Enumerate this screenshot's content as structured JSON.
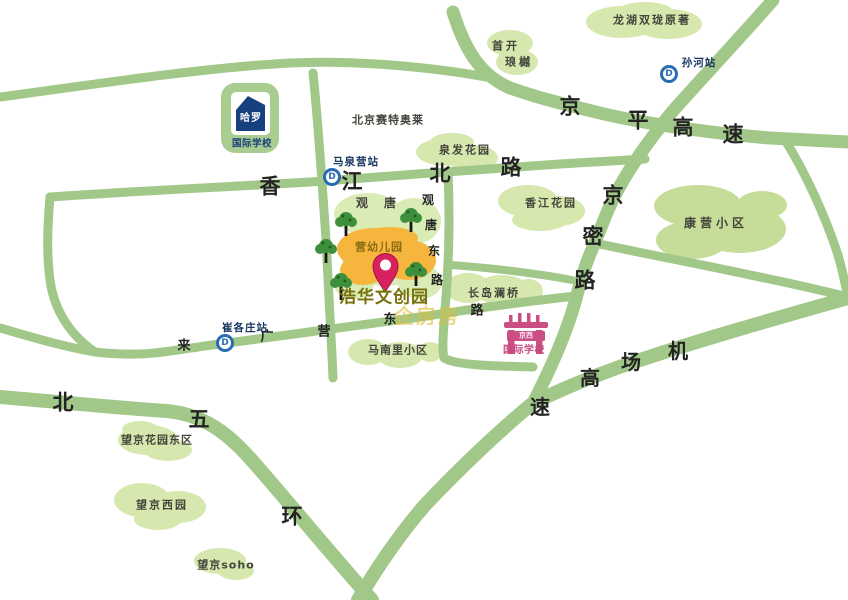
{
  "map": {
    "colors": {
      "road": "#a2c889",
      "area": "#d6e8ae",
      "area_dark": "#c6dd99",
      "area_light": "#d9ecb6",
      "orange": "#f6b63e",
      "tree": "#3e8f3b",
      "pin": "#d8215f",
      "station_blue": "#2a6cb2",
      "station_text": "#16365f",
      "harrow_blue": "#17407e",
      "pink": "#cb4f84",
      "road_text": "#232323",
      "area_text": "#44443c",
      "destination_text": "#77710a",
      "watermark": "#e2bd3a"
    },
    "station_icon_letter": "D",
    "road_label_groups": [
      {
        "id": "xiangjiang-north-road",
        "road": "香江北路",
        "size": 21,
        "chars": [
          {
            "t": "香",
            "x": 270,
            "y": 187
          },
          {
            "t": "江",
            "x": 352,
            "y": 182
          },
          {
            "t": "北",
            "x": 440,
            "y": 174
          },
          {
            "t": "路",
            "x": 511,
            "y": 168
          }
        ]
      },
      {
        "id": "jingping-expressway",
        "road": "京平高速",
        "size": 21,
        "chars": [
          {
            "t": "京",
            "x": 570,
            "y": 107
          },
          {
            "t": "平",
            "x": 638,
            "y": 121
          },
          {
            "t": "高",
            "x": 683,
            "y": 128
          },
          {
            "t": "速",
            "x": 733,
            "y": 135
          }
        ]
      },
      {
        "id": "jingmi-road",
        "road": "京密路",
        "size": 21,
        "chars": [
          {
            "t": "京",
            "x": 613,
            "y": 196
          },
          {
            "t": "密",
            "x": 593,
            "y": 237
          },
          {
            "t": "路",
            "x": 585,
            "y": 281
          }
        ]
      },
      {
        "id": "airport-expressway",
        "road": "机场高速",
        "size": 20,
        "chars": [
          {
            "t": "机",
            "x": 678,
            "y": 351
          },
          {
            "t": "场",
            "x": 631,
            "y": 362
          },
          {
            "t": "高",
            "x": 590,
            "y": 378
          },
          {
            "t": "速",
            "x": 540,
            "y": 407
          }
        ]
      },
      {
        "id": "north-fifth-ring",
        "road": "北五环",
        "size": 21,
        "chars": [
          {
            "t": "北",
            "x": 63,
            "y": 403
          },
          {
            "t": "五",
            "x": 199,
            "y": 420
          },
          {
            "t": "环",
            "x": 292,
            "y": 517
          }
        ]
      },
      {
        "id": "laiguangying-east-road",
        "road": "来广营东路",
        "size": 13,
        "chars": [
          {
            "t": "来",
            "x": 184,
            "y": 346
          },
          {
            "t": "广",
            "x": 267,
            "y": 337
          },
          {
            "t": "营",
            "x": 324,
            "y": 332
          },
          {
            "t": "东",
            "x": 390,
            "y": 320
          },
          {
            "t": "路",
            "x": 477,
            "y": 311
          }
        ]
      },
      {
        "id": "guantang-east-road",
        "road": "观唐东路",
        "size": 12,
        "chars": [
          {
            "t": "观",
            "x": 428,
            "y": 200
          },
          {
            "t": "唐",
            "x": 431,
            "y": 225
          },
          {
            "t": "东",
            "x": 434,
            "y": 251
          },
          {
            "t": "路",
            "x": 437,
            "y": 280
          }
        ]
      }
    ],
    "area_labels": [
      {
        "id": "beijing-scitech-outlets",
        "text": "北京赛特奥莱",
        "x": 388,
        "y": 120,
        "ls": 1
      },
      {
        "id": "longhu-shuanglong",
        "text": "龙湖双珑原著",
        "x": 652,
        "y": 20,
        "ls": 2
      },
      {
        "id": "shoukai-line1",
        "text": "首开",
        "x": 506,
        "y": 46,
        "ls": 3
      },
      {
        "id": "shoukai-line2",
        "text": "琅樾",
        "x": 519,
        "y": 62,
        "ls": 3
      },
      {
        "id": "quanfa-garden",
        "text": "泉发花园",
        "x": 465,
        "y": 150,
        "ls": 2
      },
      {
        "id": "xiangjiang-garden",
        "text": "香江花园",
        "x": 551,
        "y": 203,
        "ls": 2
      },
      {
        "id": "kangying-community",
        "text": "康营小区",
        "x": 716,
        "y": 223,
        "size": 12,
        "ls": 4
      },
      {
        "id": "guantang-char1",
        "text": "观",
        "x": 362,
        "y": 203,
        "size": 12
      },
      {
        "id": "guantang-char2",
        "text": "唐",
        "x": 390,
        "y": 203,
        "size": 12
      },
      {
        "id": "changdao-lanqiao",
        "text": "长岛澜桥",
        "x": 494,
        "y": 293,
        "ls": 2
      },
      {
        "id": "mananli-community",
        "text": "马南里小区",
        "x": 398,
        "y": 350,
        "ls": 1
      },
      {
        "id": "wangjing-garden-east",
        "text": "望京花园东区",
        "x": 157,
        "y": 440,
        "ls": 1
      },
      {
        "id": "wangjing-west-garden",
        "text": "望京西园",
        "x": 162,
        "y": 505,
        "ls": 2
      },
      {
        "id": "wangjing-soho",
        "text": "望京soho",
        "x": 226,
        "y": 565,
        "ls": 1
      }
    ],
    "poi_labels": [
      {
        "id": "harrow-name",
        "text": "哈罗",
        "x": 251,
        "y": 119,
        "size": 10,
        "color": "#ffffff",
        "ls": 1,
        "weight": 800
      },
      {
        "id": "harrow-subtitle",
        "text": "国际学校",
        "x": 252,
        "y": 144,
        "size": 9.5,
        "color": "#17407e",
        "ls": 0.5
      },
      {
        "id": "kindergarten-label",
        "text": "营幼儿园",
        "x": 379,
        "y": 247,
        "size": 11,
        "color": "#8a6a12",
        "ls": 1
      },
      {
        "id": "destination-name",
        "text": "浩华文创园",
        "x": 384,
        "y": 298,
        "size": 17,
        "color": "#77710a",
        "ls": 1,
        "weight": 800
      },
      {
        "id": "jingxi-gate-text",
        "text": "京西",
        "x": 526,
        "y": 336,
        "size": 7,
        "color": "#ffe9f2",
        "weight": 800
      },
      {
        "id": "jingxi-subtitle",
        "text": "国际学校",
        "x": 524,
        "y": 351,
        "size": 10,
        "color": "#c6497f",
        "ls": 0.5
      }
    ],
    "stations": [
      {
        "id": "maquanying",
        "label": "马泉营站",
        "icon": {
          "x": 332,
          "y": 177
        },
        "label_pos": {
          "x": 356,
          "y": 162
        }
      },
      {
        "id": "cuigezhuang",
        "label": "崔各庄站",
        "icon": {
          "x": 225,
          "y": 343
        },
        "label_pos": {
          "x": 245,
          "y": 328
        }
      },
      {
        "id": "sunhe",
        "label": "孙河站",
        "icon": {
          "x": 669,
          "y": 74
        },
        "label_pos": {
          "x": 699,
          "y": 63
        }
      }
    ],
    "watermark": {
      "text": "企房房",
      "x": 427,
      "y": 316,
      "size": 20
    }
  }
}
